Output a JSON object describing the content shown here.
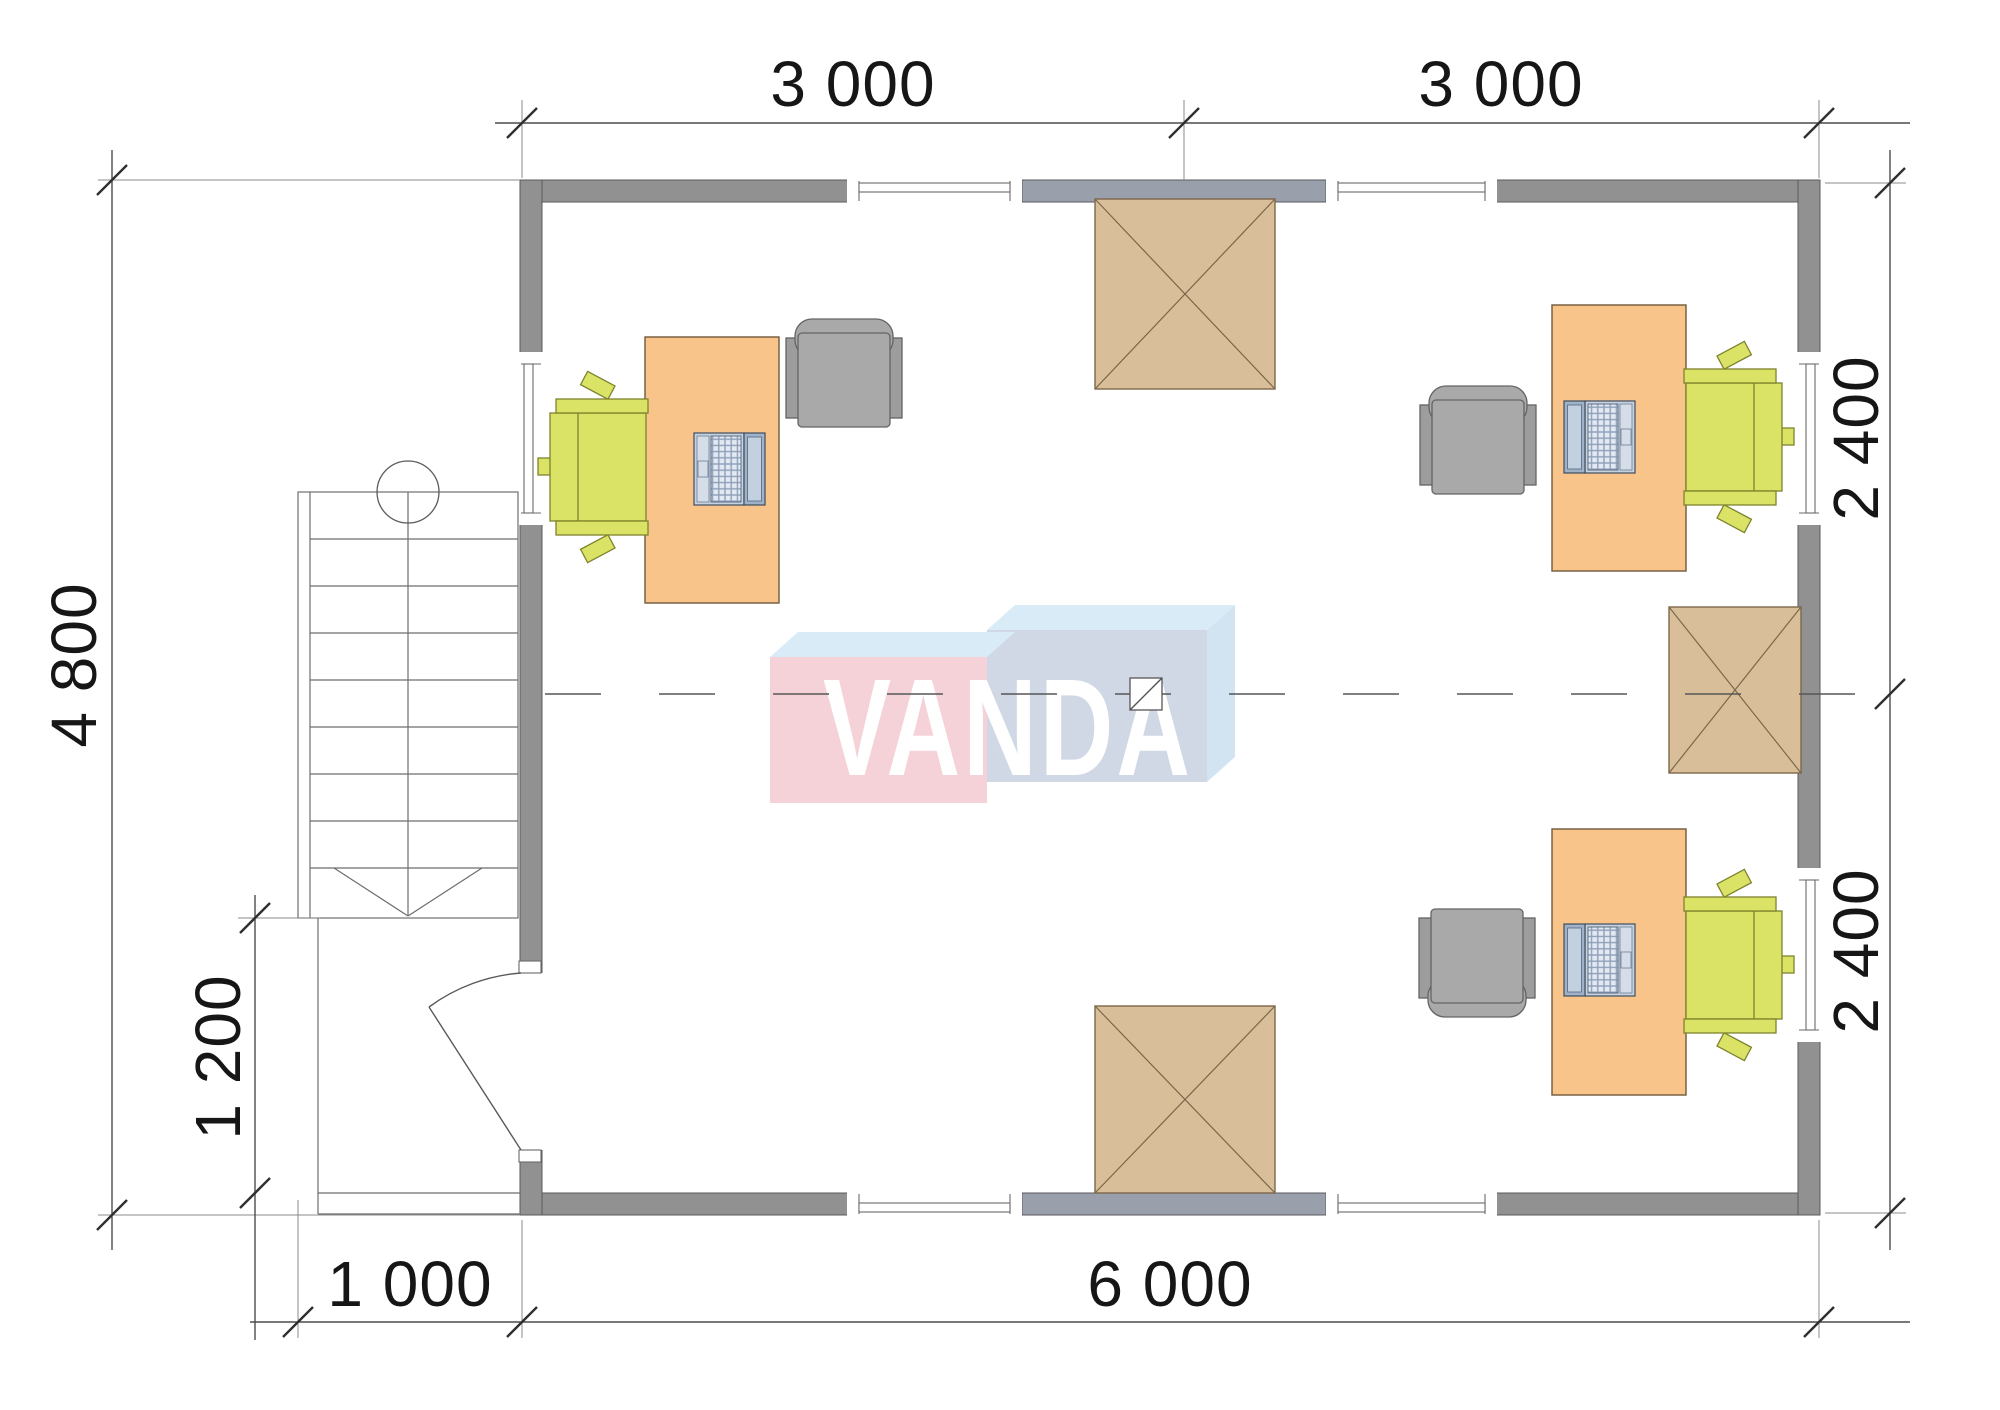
{
  "watermark": {
    "text": "VANDA"
  },
  "dimensions": {
    "top_left": "3 000",
    "top_right": "3 000",
    "right_upper": "2 400",
    "right_lower": "2 400",
    "left_total": "4 800",
    "left_porch": "1 200",
    "bottom_porch": "1 000",
    "bottom_total": "6 000"
  },
  "plan_summary": {
    "type": "floor-plan",
    "building_width_mm": 6000,
    "building_depth_mm": 4800,
    "top_bays_mm": [
      3000,
      3000
    ],
    "right_bays_mm": [
      2400,
      2400
    ],
    "porch_width_mm": 1000,
    "porch_depth_mm": 1200,
    "workstations": 3,
    "desks": 3,
    "laptops": 3,
    "task_chairs": 3,
    "armchairs": 3,
    "hatched_openings": 3,
    "windows": 7,
    "doors": 1,
    "staircases": 1
  },
  "colors": {
    "wall": "#919191",
    "wall_accent": "#99a0ac",
    "desk": "#f9c489",
    "task_chair": "#dae366",
    "armchair": "#a9a9a9",
    "hatch_box": "#d9bf99",
    "hatch_line": "#7d664a",
    "laptop": "#c6d2e0",
    "logo_pink": "#f5cfd6",
    "logo_blue_front": "#cdd6e4",
    "logo_blue_top": "#d6eaf6",
    "logo_letters": "#ffffff",
    "dim_text": "#161616",
    "lines": "#555555"
  }
}
